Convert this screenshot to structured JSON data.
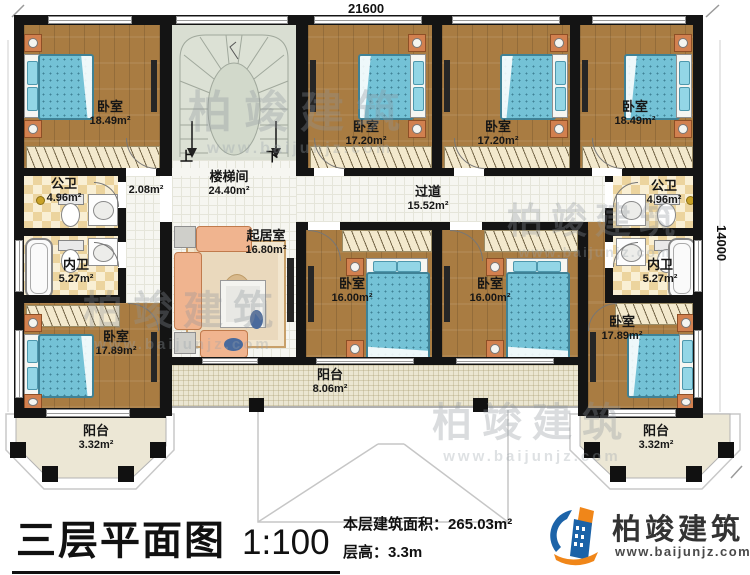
{
  "dimensions": {
    "top": "21600",
    "right": "14000"
  },
  "stairs": {
    "up": "上",
    "down": "下"
  },
  "rooms": {
    "bedroom_tl": {
      "name": "卧室",
      "area": "18.49m²"
    },
    "bedroom_t1": {
      "name": "卧室",
      "area": "17.20m²"
    },
    "bedroom_t2": {
      "name": "卧室",
      "area": "17.20m²"
    },
    "bedroom_tr": {
      "name": "卧室",
      "area": "18.49m²"
    },
    "stairwell": {
      "name": "楼梯间",
      "area": "24.40m²"
    },
    "landing": {
      "area": "2.08m²"
    },
    "corridor": {
      "name": "过道",
      "area": "15.52m²"
    },
    "living": {
      "name": "起居室",
      "area": "16.80m²"
    },
    "bath_public_left": {
      "name": "公卫",
      "area": "4.96m²"
    },
    "bath_private_left": {
      "name": "内卫",
      "area": "5.27m²"
    },
    "bath_public_right": {
      "name": "公卫",
      "area": "4.96m²"
    },
    "bath_private_right": {
      "name": "内卫",
      "area": "5.27m²"
    },
    "bedroom_m1": {
      "name": "卧室",
      "area": "16.00m²"
    },
    "bedroom_m2": {
      "name": "卧室",
      "area": "16.00m²"
    },
    "bedroom_bl": {
      "name": "卧室",
      "area": "17.89m²"
    },
    "bedroom_br": {
      "name": "卧室",
      "area": "17.89m²"
    },
    "balcony_left": {
      "name": "阳台",
      "area": "3.32m²"
    },
    "balcony_center": {
      "name": "阳台",
      "area": "8.06m²"
    },
    "balcony_right": {
      "name": "阳台",
      "area": "3.32m²"
    }
  },
  "watermark": {
    "brand": "柏竣建筑",
    "url": "www.baijunjz.com"
  },
  "footer": {
    "title": "三层平面图",
    "scale": "1:100",
    "floor_area_label": "本层建筑面积：",
    "floor_area_value": "265.03m²",
    "floor_height_label": "层高：",
    "floor_height_value": "3.3m",
    "brand": "柏竣建筑",
    "url": "www.baijunjz.com"
  }
}
